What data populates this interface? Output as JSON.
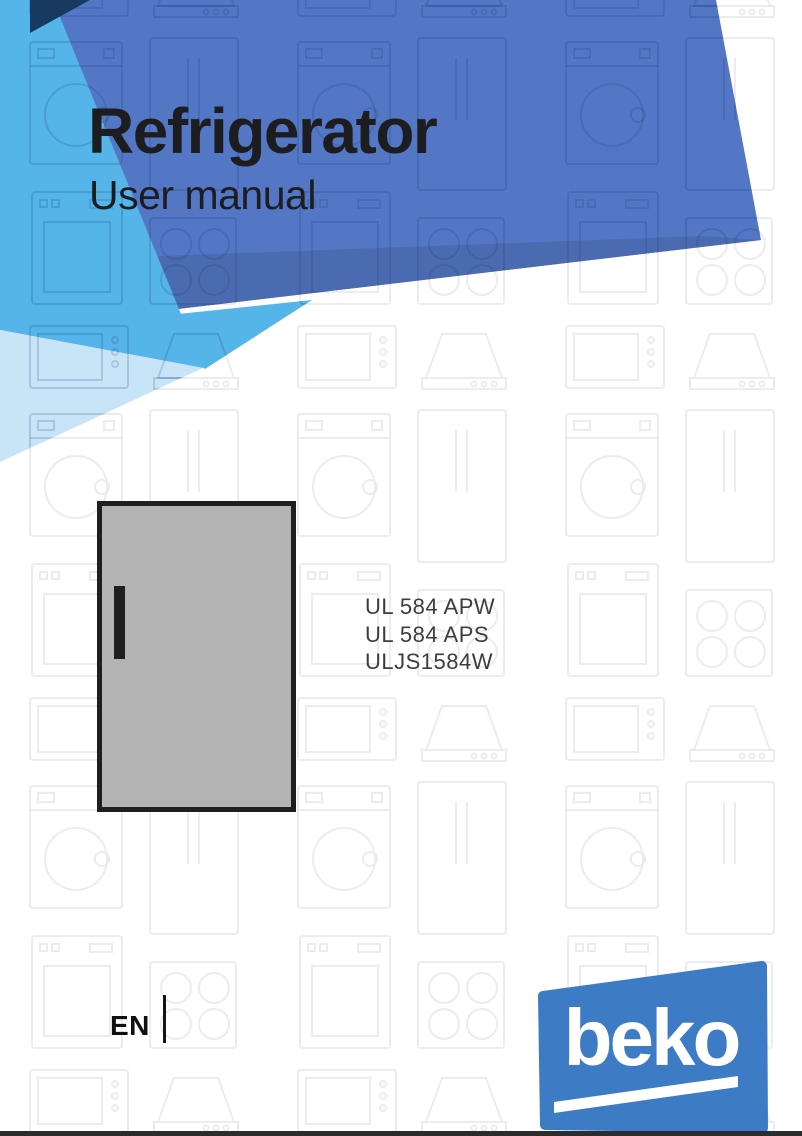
{
  "page": {
    "title": "Refrigerator",
    "subtitle": "User manual",
    "language": "EN",
    "models": [
      "UL 584 APW",
      "UL 584 APS",
      "ULJS1584W"
    ],
    "brand": {
      "logo_text": "beko",
      "logo_color": "#3d7cc4"
    },
    "colors": {
      "banner_blue": "#5377c4",
      "banner_band_dark": "#4a6bb0",
      "light_blue": "#55b5e8",
      "pale_blue": "#c8e5f8",
      "navy": "#183a5e",
      "title_text": "#1d1d20",
      "model_text": "#3d3d3f",
      "fridge_gray": "#b3b4b3"
    },
    "illustration": "refrigerator-front-door"
  }
}
